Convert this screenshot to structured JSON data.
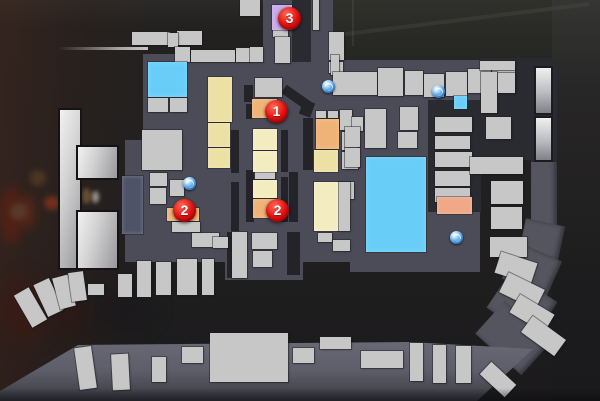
{
  "scene": {
    "type": "game-overhead-map-overlay",
    "canvas": {
      "width": 600,
      "height": 401
    }
  },
  "palette": {
    "street": "#4c4c58",
    "road": "#55555f",
    "dark_block": "#2a2a31",
    "alley": "#232329",
    "building": "#c7c7c7",
    "water": "#68cef8",
    "tan": "#ece0a4",
    "tan_light": "#f4ecc1",
    "orange": "#f0b377",
    "salmon": "#efa888",
    "purple": "#c9abe9",
    "blue_gray": "#4e5368",
    "marker_red": "#e41414",
    "item_blue": "#3b87d8",
    "background": "#222020"
  },
  "markers": [
    {
      "label": "1",
      "x": 276,
      "y": 111
    },
    {
      "label": "2",
      "x": 184,
      "y": 210
    },
    {
      "label": "2",
      "x": 277,
      "y": 210
    },
    {
      "label": "3",
      "x": 289,
      "y": 18
    }
  ],
  "item_icons": [
    {
      "name": "item-pickup-icon",
      "x": 189,
      "y": 183
    },
    {
      "name": "item-pickup-icon",
      "x": 328,
      "y": 86
    },
    {
      "name": "item-pickup-icon",
      "x": 438,
      "y": 91
    },
    {
      "name": "item-pickup-icon",
      "x": 456,
      "y": 237
    }
  ],
  "map_shapes": {
    "background_blobs": [
      {
        "r": [
          0,
          186,
          22,
          58
        ],
        "c": "#5e2012",
        "o": 0.75,
        "blur": 5,
        "n": "bg-red-object"
      },
      {
        "r": [
          20,
          196,
          14,
          32
        ],
        "c": "#7a2a14",
        "o": 0.6,
        "blur": 5,
        "n": "bg-red-object"
      },
      {
        "r": [
          44,
          196,
          16,
          14
        ],
        "c": "#93351c",
        "o": 0.7,
        "blur": 3,
        "n": "bg-red-object"
      },
      {
        "r": [
          10,
          203,
          16,
          17
        ],
        "c": "#5a4a3a",
        "o": 0.6,
        "blur": 3,
        "n": "bg-crate-object"
      },
      {
        "r": [
          30,
          170,
          16,
          16
        ],
        "c": "#6b4a28",
        "o": 0.5,
        "blur": 3,
        "n": "bg-crate-object"
      },
      {
        "r": [
          82,
          188,
          9,
          16
        ],
        "c": "#7a5a38",
        "o": 0.8,
        "blur": 2,
        "n": "bg-bottle-object"
      },
      {
        "r": [
          92,
          191,
          7,
          12
        ],
        "c": "#cfc8bd",
        "o": 0.7,
        "blur": 2,
        "n": "bg-bottle-object"
      },
      {
        "r": [
          0,
          278,
          46,
          64
        ],
        "c": "#421610",
        "o": 0.5,
        "blur": 9,
        "n": "bg-red-object"
      },
      {
        "r": [
          56,
          296,
          30,
          38
        ],
        "c": "#33150f",
        "o": 0.5,
        "blur": 8,
        "n": "bg-shadow"
      },
      {
        "r": [
          95,
          290,
          60,
          40
        ],
        "c": "#18171a",
        "o": 0.6,
        "blur": 9,
        "n": "bg-shadow"
      }
    ],
    "streets": [
      [
        143,
        60,
        337,
        202
      ],
      [
        263,
        0,
        37,
        62
      ],
      [
        311,
        0,
        22,
        78
      ],
      [
        125,
        140,
        18,
        122
      ],
      [
        225,
        260,
        78,
        20
      ],
      [
        350,
        260,
        130,
        12
      ],
      [
        143,
        54,
        120,
        10
      ]
    ],
    "road_segments": [
      [
        531,
        58,
        26,
        178
      ],
      [
        522,
        222,
        40,
        34,
        12
      ],
      [
        508,
        250,
        48,
        40,
        24
      ],
      [
        494,
        283,
        56,
        44,
        34
      ],
      [
        482,
        316,
        62,
        44,
        42
      ]
    ],
    "band": {
      "rect": [
        0,
        333,
        545,
        68
      ],
      "points": "0px 58px, 78px 12px, 410px 9px, 533px 16px, 477px 68px, 0px 68px"
    },
    "dark_blocks": [
      [
        292,
        0,
        19,
        62
      ],
      [
        428,
        100,
        53,
        112
      ],
      [
        480,
        58,
        51,
        102
      ],
      [
        531,
        58,
        26,
        104
      ]
    ],
    "alleys": [
      [
        244,
        85,
        9,
        17
      ],
      [
        246,
        104,
        7,
        15
      ],
      [
        231,
        130,
        8,
        43
      ],
      [
        281,
        130,
        7,
        42
      ],
      [
        231,
        182,
        8,
        49
      ],
      [
        281,
        177,
        7,
        45
      ],
      [
        246,
        170,
        8,
        52
      ],
      [
        289,
        172,
        9,
        50
      ],
      [
        227,
        232,
        7,
        46
      ],
      [
        287,
        232,
        13,
        43
      ],
      [
        303,
        118,
        10,
        52
      ],
      [
        281,
        93,
        32,
        10,
        35
      ],
      [
        301,
        101,
        12,
        15,
        20
      ]
    ],
    "buildings": [
      [
        240,
        0,
        20,
        16
      ],
      [
        132,
        32,
        38,
        13
      ],
      [
        177,
        31,
        25,
        14
      ],
      [
        168,
        33,
        10,
        14
      ],
      [
        175,
        47,
        15,
        15
      ],
      [
        191,
        50,
        44,
        12
      ],
      [
        236,
        48,
        14,
        14
      ],
      [
        250,
        47,
        13,
        15
      ],
      [
        273,
        30,
        15,
        7
      ],
      [
        275,
        37,
        15,
        26
      ],
      [
        313,
        0,
        6,
        30
      ],
      [
        329,
        32,
        15,
        28
      ],
      [
        329,
        62,
        14,
        11
      ],
      [
        331,
        55,
        8,
        20
      ],
      [
        333,
        72,
        44,
        23
      ],
      [
        378,
        68,
        25,
        28
      ],
      [
        405,
        71,
        18,
        24
      ],
      [
        424,
        74,
        20,
        23
      ],
      [
        446,
        72,
        21,
        24
      ],
      [
        468,
        69,
        23,
        24
      ],
      [
        492,
        67,
        23,
        24
      ],
      [
        148,
        98,
        20,
        14
      ],
      [
        170,
        98,
        17,
        14
      ],
      [
        142,
        130,
        40,
        40
      ],
      [
        150,
        173,
        17,
        13
      ],
      [
        170,
        180,
        14,
        16
      ],
      [
        150,
        188,
        16,
        16
      ],
      [
        172,
        222,
        28,
        10
      ],
      [
        192,
        233,
        27,
        14
      ],
      [
        213,
        237,
        15,
        11
      ],
      [
        232,
        232,
        15,
        46
      ],
      [
        252,
        233,
        25,
        16
      ],
      [
        253,
        251,
        19,
        16
      ],
      [
        255,
        78,
        27,
        19
      ],
      [
        255,
        172,
        20,
        7
      ],
      [
        316,
        111,
        10,
        7
      ],
      [
        328,
        111,
        10,
        7
      ],
      [
        340,
        110,
        12,
        20
      ],
      [
        352,
        117,
        11,
        14
      ],
      [
        342,
        132,
        16,
        18
      ],
      [
        342,
        152,
        16,
        17
      ],
      [
        340,
        182,
        14,
        17
      ],
      [
        345,
        127,
        15,
        20
      ],
      [
        345,
        148,
        15,
        19
      ],
      [
        365,
        109,
        21,
        39
      ],
      [
        400,
        107,
        18,
        23
      ],
      [
        398,
        132,
        19,
        16
      ],
      [
        318,
        233,
        14,
        9
      ],
      [
        333,
        240,
        17,
        11
      ],
      [
        338,
        182,
        12,
        49
      ],
      [
        435,
        117,
        37,
        15
      ],
      [
        435,
        136,
        35,
        13
      ],
      [
        435,
        152,
        37,
        15
      ],
      [
        435,
        171,
        35,
        15
      ],
      [
        435,
        188,
        35,
        14
      ],
      [
        480,
        61,
        35,
        9
      ],
      [
        481,
        72,
        16,
        41
      ],
      [
        498,
        73,
        17,
        20
      ],
      [
        486,
        117,
        25,
        22
      ],
      [
        470,
        157,
        53,
        17
      ],
      [
        491,
        181,
        32,
        23
      ],
      [
        491,
        207,
        31,
        22
      ],
      [
        490,
        237,
        37,
        20
      ],
      [
        118,
        274,
        14,
        23
      ],
      [
        137,
        261,
        14,
        36
      ],
      [
        156,
        262,
        15,
        33
      ],
      [
        177,
        259,
        20,
        36
      ],
      [
        202,
        259,
        12,
        36
      ],
      [
        88,
        284,
        16,
        11
      ],
      [
        210,
        333,
        78,
        49
      ],
      [
        320,
        337,
        31,
        12
      ],
      [
        361,
        351,
        42,
        17
      ],
      [
        410,
        343,
        13,
        38
      ],
      [
        433,
        345,
        13,
        38
      ],
      [
        456,
        346,
        15,
        37
      ],
      [
        182,
        347,
        21,
        16
      ],
      [
        293,
        348,
        21,
        15
      ],
      [
        152,
        357,
        14,
        25
      ],
      [
        22,
        289,
        17,
        37,
        -30
      ],
      [
        40,
        280,
        17,
        35,
        -25
      ],
      [
        56,
        276,
        16,
        32,
        -15
      ],
      [
        70,
        272,
        15,
        29,
        -8
      ],
      [
        497,
        257,
        38,
        22,
        18
      ],
      [
        502,
        280,
        40,
        22,
        26
      ],
      [
        512,
        303,
        40,
        21,
        31
      ],
      [
        523,
        326,
        41,
        20,
        36
      ],
      [
        481,
        371,
        34,
        17,
        43
      ],
      [
        77,
        347,
        17,
        42,
        -8
      ],
      [
        112,
        354,
        17,
        36,
        -3
      ]
    ],
    "rooms": [
      {
        "r": [
          148,
          62,
          39,
          35
        ],
        "c": "water",
        "n": "water-pool"
      },
      {
        "r": [
          366,
          157,
          60,
          95
        ],
        "c": "water",
        "n": "water-pool-large"
      },
      {
        "r": [
          454,
          96,
          13,
          13
        ],
        "c": "water",
        "n": "water-pool-small"
      },
      {
        "r": [
          272,
          5,
          20,
          25
        ],
        "c": "purple",
        "n": "room-purple"
      },
      {
        "r": [
          208,
          77,
          24,
          45
        ],
        "c": "tan",
        "n": "room-tan"
      },
      {
        "r": [
          208,
          123,
          22,
          24
        ],
        "c": "tan",
        "n": "room-tan"
      },
      {
        "r": [
          208,
          148,
          22,
          20
        ],
        "c": "tan",
        "n": "room-tan"
      },
      {
        "r": [
          252,
          99,
          25,
          19
        ],
        "c": "orange",
        "n": "room-orange-objective-1"
      },
      {
        "r": [
          253,
          129,
          24,
          21
        ],
        "c": "tan_light",
        "n": "room-tan"
      },
      {
        "r": [
          253,
          151,
          24,
          21
        ],
        "c": "tan_light",
        "n": "room-tan"
      },
      {
        "r": [
          253,
          180,
          24,
          18
        ],
        "c": "tan_light",
        "n": "room-tan"
      },
      {
        "r": [
          253,
          199,
          24,
          19
        ],
        "c": "orange",
        "n": "room-orange-objective-2"
      },
      {
        "r": [
          167,
          208,
          32,
          13
        ],
        "c": "orange",
        "n": "room-orange-objective-2-west"
      },
      {
        "r": [
          316,
          119,
          23,
          30
        ],
        "c": "orange",
        "n": "room-orange"
      },
      {
        "r": [
          314,
          150,
          24,
          22
        ],
        "c": "tan",
        "n": "room-tan"
      },
      {
        "r": [
          314,
          182,
          24,
          49
        ],
        "c": "tan_light",
        "n": "room-tan-large"
      },
      {
        "r": [
          437,
          197,
          35,
          17
        ],
        "c": "salmon",
        "n": "room-salmon"
      },
      {
        "r": [
          122,
          176,
          21,
          58
        ],
        "c": "blue_gray",
        "n": "room-blue-gray"
      }
    ],
    "columns": [
      [
        536,
        68,
        15,
        45
      ],
      [
        536,
        118,
        15,
        42
      ]
    ],
    "tower": [
      [
        60,
        110,
        20,
        158
      ],
      [
        78,
        147,
        39,
        31
      ],
      [
        78,
        212,
        39,
        56
      ]
    ],
    "wall_line": [
      58,
      47,
      90,
      3
    ]
  }
}
